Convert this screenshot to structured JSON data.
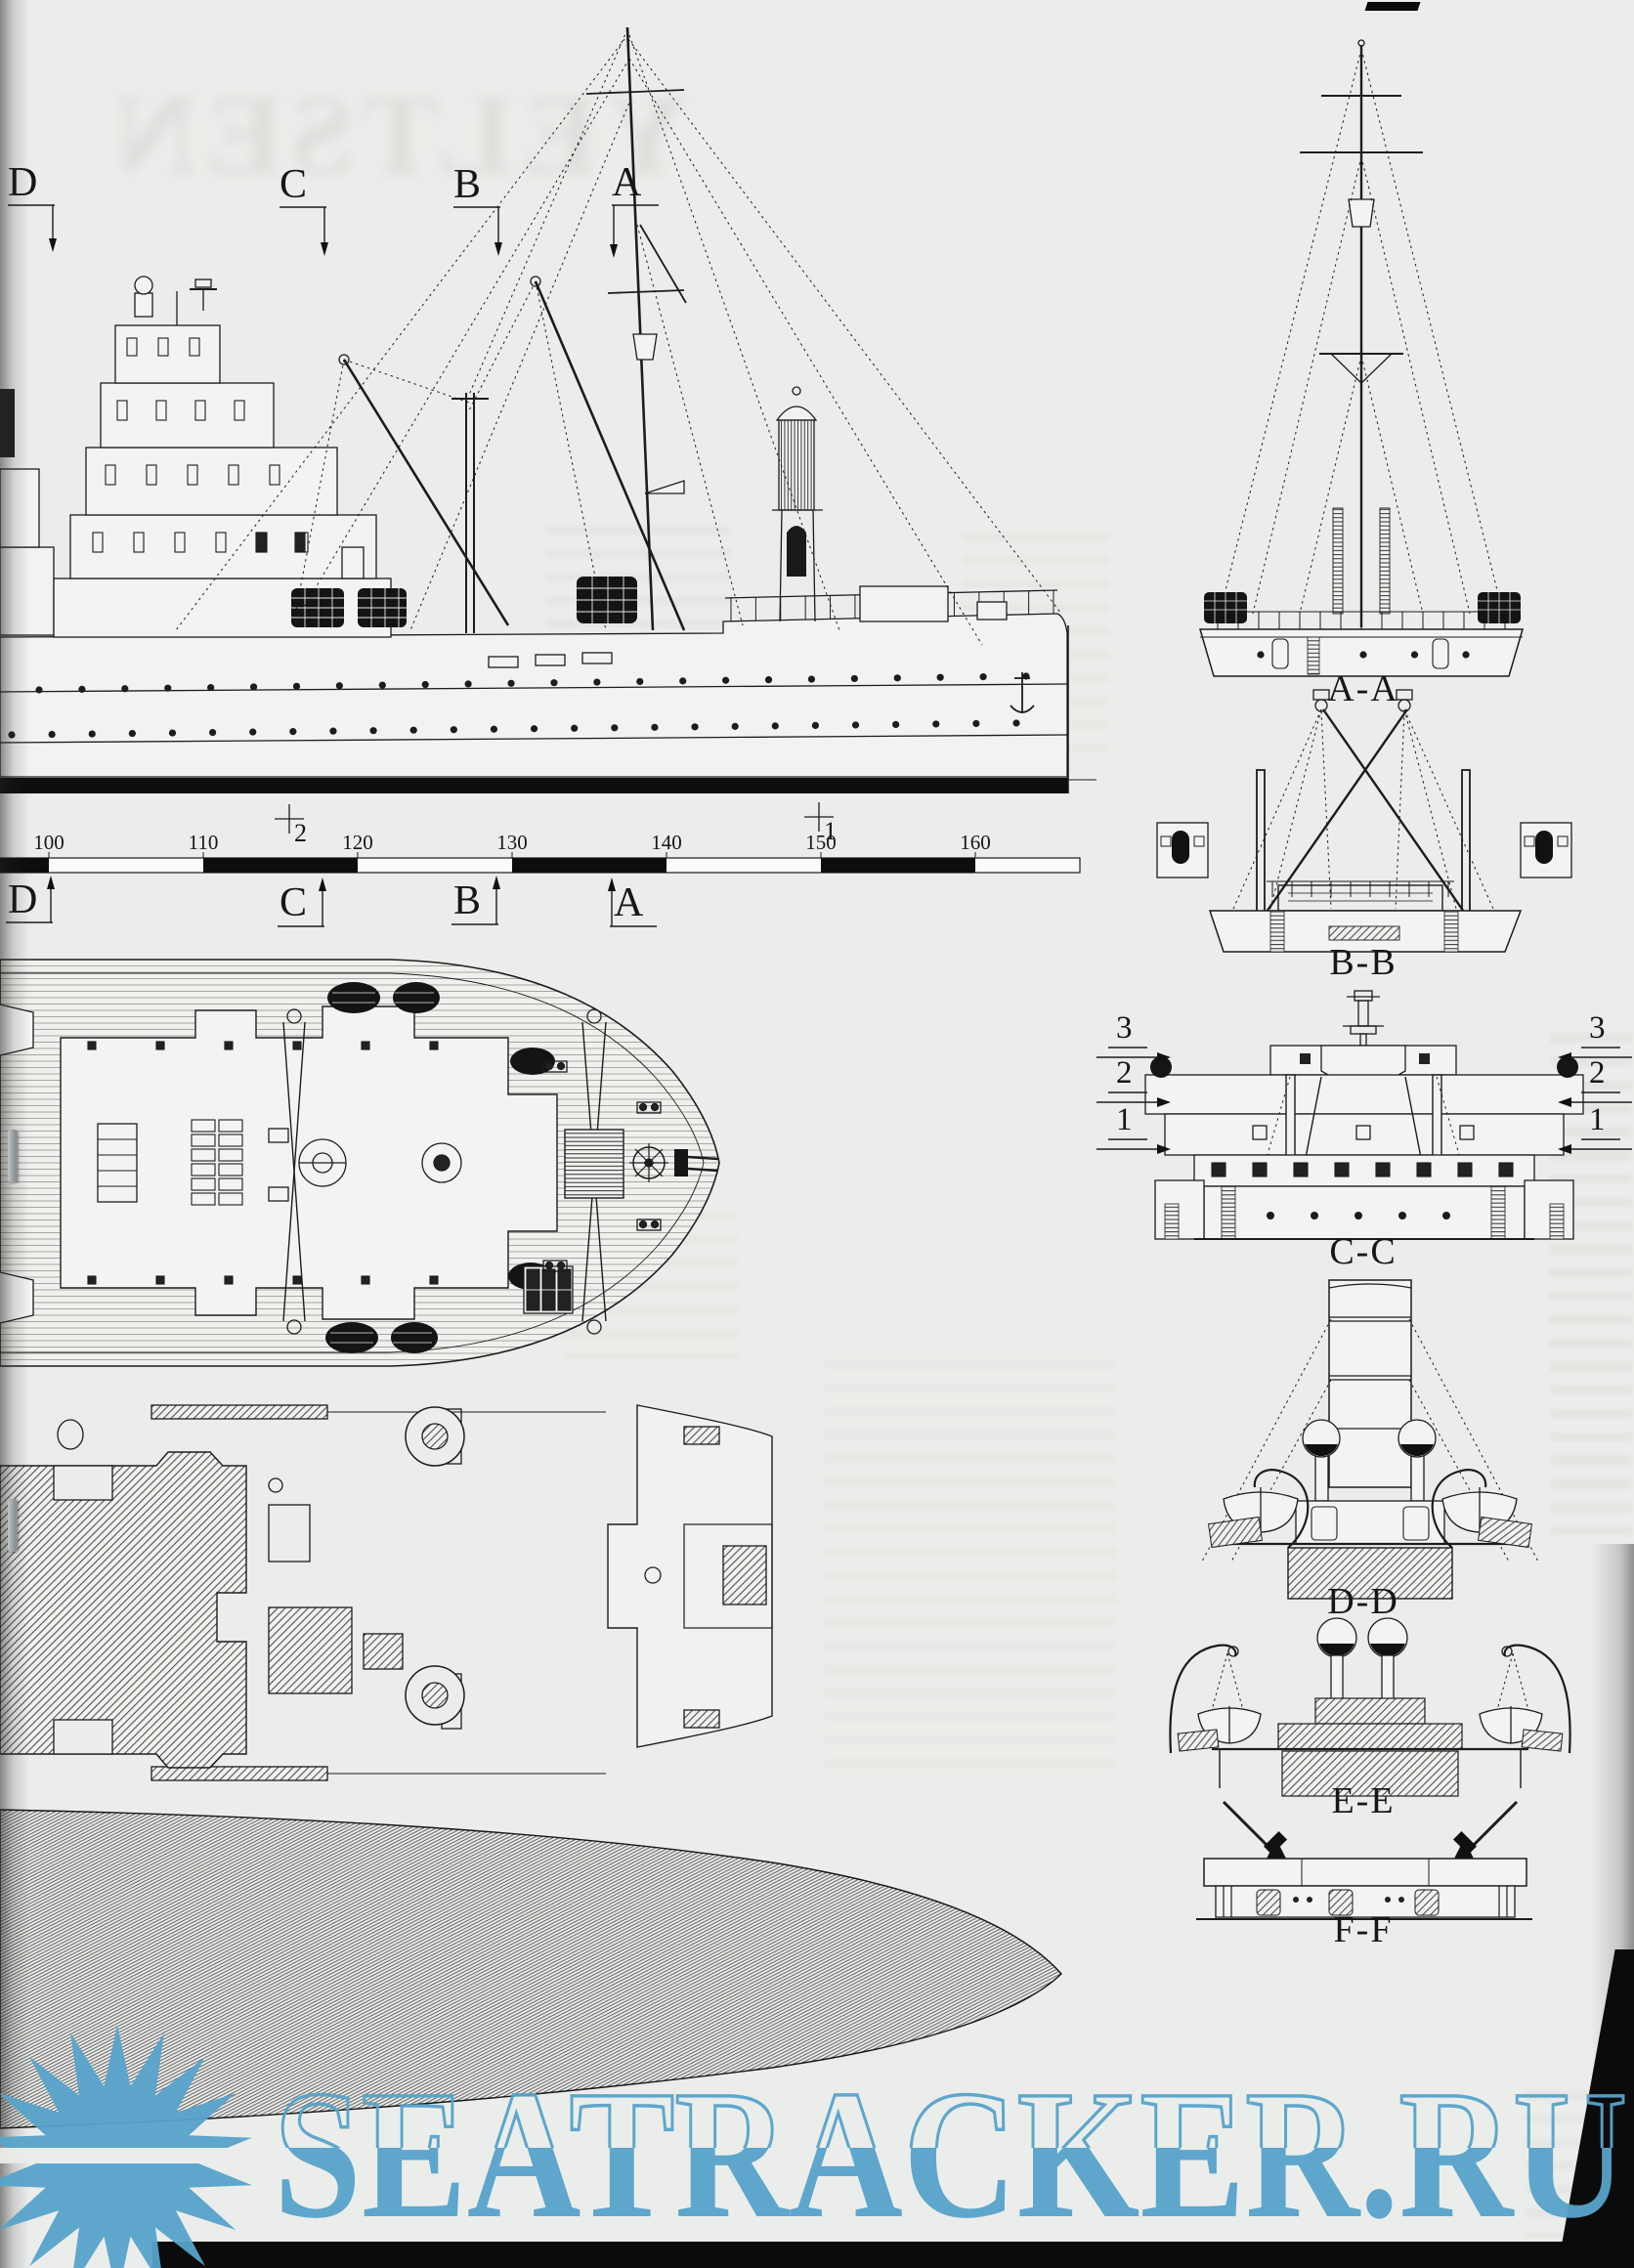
{
  "page": {
    "watermark": {
      "text": "SEATRACKER.RU",
      "color": "#57a3cb",
      "logo": "sun-logo"
    },
    "ghost_title": "YELTSEN"
  },
  "side_view": {
    "section_markers_top": [
      "D",
      "C",
      "B",
      "A"
    ],
    "section_markers_bottom": [
      "D",
      "C",
      "B",
      "A"
    ],
    "station_crosses": [
      "2",
      "1"
    ]
  },
  "ruler": {
    "ticks": [
      "100",
      "110",
      "120",
      "130",
      "140",
      "150",
      "160"
    ]
  },
  "cross_sections": {
    "labels": [
      "A-A",
      "B-B",
      "C-C",
      "D-D",
      "E-E",
      "F-F"
    ],
    "deck_levels": [
      "3",
      "2",
      "1"
    ]
  }
}
